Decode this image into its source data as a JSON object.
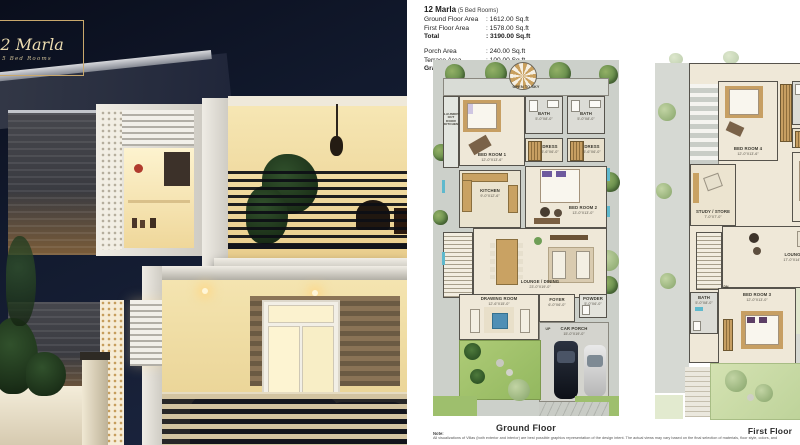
{
  "badge": {
    "title": "12 Marla",
    "subtitle": "5 Bed Rooms"
  },
  "header": {
    "title": "12 Marla",
    "title_suffix": "(5 Bed Rooms)",
    "rows": [
      {
        "label": "Ground Floor Area",
        "value": ":  1612.00 Sq.ft"
      },
      {
        "label": "First Floor Area",
        "value": ":  1578.00 Sq.ft"
      },
      {
        "label": "Total",
        "value": ":  3190.00 Sq.ft"
      }
    ],
    "rows2": [
      {
        "label": "Porch Area",
        "value": ":  240.00 Sq.ft"
      },
      {
        "label": "Terrace Area",
        "value": ":  100.00 Sq.ft"
      },
      {
        "label": "Grand Total",
        "value": ":  3530.00 Sq.ft"
      }
    ]
  },
  "plans": {
    "ground": {
      "caption": "Ground Floor",
      "open_to_sky": "OPEN TO SKY",
      "laundry": "LAUNDRY OUT DOOR KITCHEN",
      "up_label": "UP",
      "rooms": [
        {
          "label": "BED ROOM 1",
          "dims": "12'-0\"X13'-6\""
        },
        {
          "label": "BATH",
          "dims": "5'-0\"X8'-0\""
        },
        {
          "label": "BATH",
          "dims": "5'-0\"X8'-0\""
        },
        {
          "label": "DRESS",
          "dims": "5'-6\"X6'-0\""
        },
        {
          "label": "DRESS",
          "dims": "5'-6\"X6'-0\""
        },
        {
          "label": "BED ROOM 2",
          "dims": "13'-0\"X13'-0\""
        },
        {
          "label": "KITCHEN",
          "dims": "9'-0\"X12'-6\""
        },
        {
          "label": "LOUNGE / DINING",
          "dims": "23'-0\"X19'-0\""
        },
        {
          "label": "DRAWING ROOM",
          "dims": "12'-6\"X15'-0\""
        },
        {
          "label": "FOYER",
          "dims": "6'-0\"X6'-0\""
        },
        {
          "label": "POWDER",
          "dims": "5'-0\"X6'-0\""
        },
        {
          "label": "CAR PORCH",
          "dims": "15'-0\"X19'-0\""
        }
      ]
    },
    "first": {
      "caption": "First Floor",
      "dn_label": "DN",
      "rooms": [
        {
          "label": "BED ROOM 4",
          "dims": "12'-0\"X13'-6\""
        },
        {
          "label": "BATH",
          "dims": "5'-0\"X8'-0\""
        },
        {
          "label": "DRESS",
          "dims": "5'-6\"X6'-0\""
        },
        {
          "label": "STUDY / STORE",
          "dims": "7'-0\"X7'-0\""
        },
        {
          "label": "BED ROOM 5",
          "dims": "13'-0\"X13'-0\""
        },
        {
          "label": "LOUNGE",
          "dims": "17'-0\"X14'-0\""
        },
        {
          "label": "BATH",
          "dims": "5'-0\"X8'-0\""
        },
        {
          "label": "BED ROOM 3",
          "dims": "12'-0\"X13'-0\""
        }
      ]
    }
  },
  "note": {
    "heading": "Note:",
    "body": "All visualizations of Villas (both exterior and interior) are best possible graphics representation of the design intent. The actual views may vary based on the final selection of materials, floor style, colors, and"
  },
  "colors": {
    "badge_gold": "#c9a86c",
    "lawn_green": "#a8c873",
    "accent_blue": "#5fb9cd"
  }
}
